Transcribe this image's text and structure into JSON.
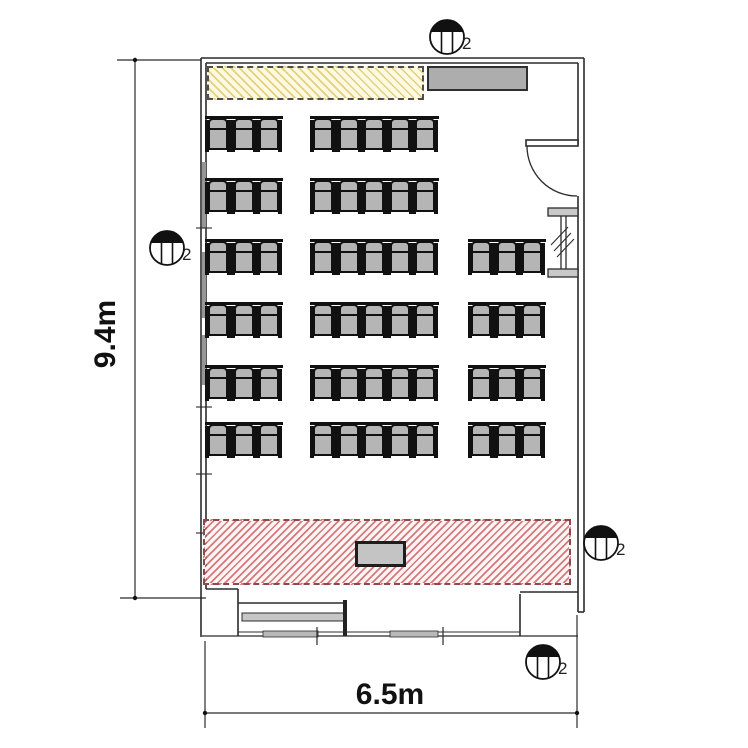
{
  "drawing_type": "classroom floor plan",
  "dimensions": {
    "height": "9.4m",
    "width": "6.5m"
  },
  "zones": {
    "whiteboard_zone": {
      "fill": "#fdf9e2",
      "hatch": "#e3cd76",
      "border": "#4d4d4d"
    },
    "presenter_zone": {
      "fill": "#fdf5f5",
      "hatch": "#c95858",
      "border": "#8a4a4a"
    }
  },
  "furniture": {
    "wall_board": {
      "fill": "#adadad"
    },
    "podium": {
      "fill": "#c4c4c4"
    },
    "entry_bench": {
      "fill": "#c6c6c6"
    }
  },
  "fixtures": {
    "label": "2",
    "items": [
      {
        "id": "top",
        "cx": 447,
        "cy": 37
      },
      {
        "id": "left",
        "cx": 167,
        "cy": 248
      },
      {
        "id": "right",
        "cx": 601,
        "cy": 543
      },
      {
        "id": "bottom",
        "cx": 543,
        "cy": 662
      }
    ]
  },
  "seating": {
    "seat_pitch": 25.6,
    "seat_height": 35,
    "seat_fill": "#b5b5b5",
    "total_seats": 60,
    "rows": [
      {
        "y": 117,
        "groups": [
          {
            "x": 205,
            "seats": 3
          },
          {
            "x": 310,
            "seats": 5
          }
        ]
      },
      {
        "y": 179,
        "groups": [
          {
            "x": 205,
            "seats": 3
          },
          {
            "x": 310,
            "seats": 5
          }
        ]
      },
      {
        "y": 240,
        "groups": [
          {
            "x": 205,
            "seats": 3
          },
          {
            "x": 310,
            "seats": 5
          },
          {
            "x": 468,
            "seats": 3
          }
        ]
      },
      {
        "y": 303,
        "groups": [
          {
            "x": 205,
            "seats": 3
          },
          {
            "x": 310,
            "seats": 5
          },
          {
            "x": 468,
            "seats": 3
          }
        ]
      },
      {
        "y": 366,
        "groups": [
          {
            "x": 205,
            "seats": 3
          },
          {
            "x": 310,
            "seats": 5
          },
          {
            "x": 468,
            "seats": 3
          }
        ]
      },
      {
        "y": 423,
        "groups": [
          {
            "x": 205,
            "seats": 3
          },
          {
            "x": 310,
            "seats": 5
          },
          {
            "x": 468,
            "seats": 3
          }
        ]
      }
    ]
  }
}
